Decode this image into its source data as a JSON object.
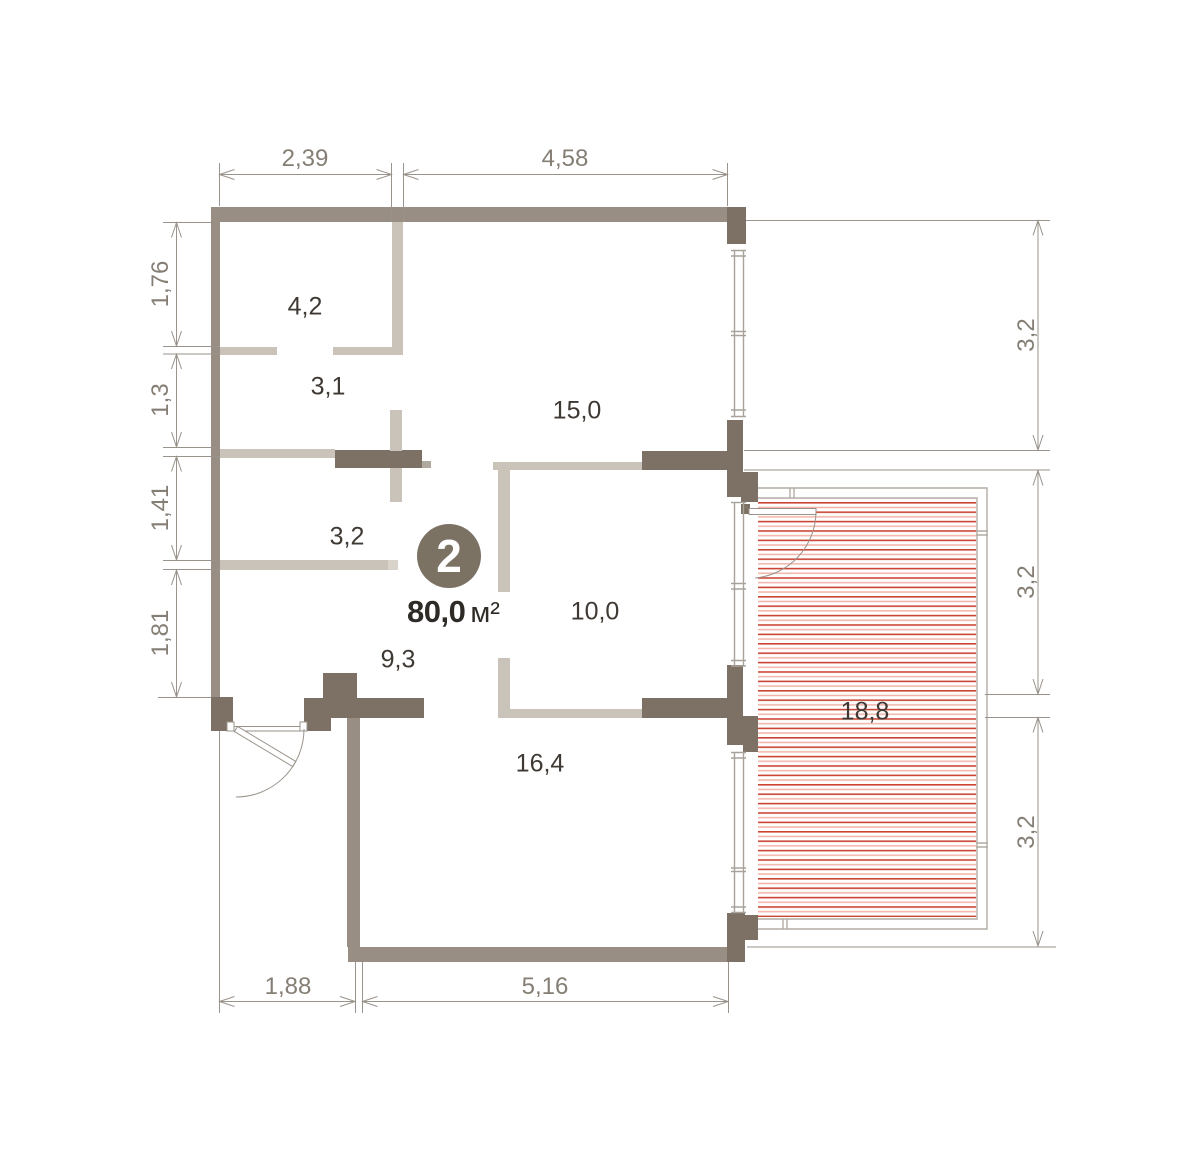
{
  "plan": {
    "badge_number": "2",
    "area_value": "80,0",
    "area_unit": "м²",
    "rooms": [
      {
        "id": "room-4-2",
        "label": "4,2"
      },
      {
        "id": "room-3-1",
        "label": "3,1"
      },
      {
        "id": "room-15-0",
        "label": "15,0"
      },
      {
        "id": "room-3-2",
        "label": "3,2"
      },
      {
        "id": "hall-9-3",
        "label": "9,3"
      },
      {
        "id": "room-10-0",
        "label": "10,0"
      },
      {
        "id": "room-16-4",
        "label": "16,4"
      },
      {
        "id": "terrace-18-8",
        "label": "18,8"
      }
    ],
    "dimensions": {
      "top": [
        "2,39",
        "4,58"
      ],
      "left": [
        "1,76",
        "1,3",
        "1,41",
        "1,81"
      ],
      "right": [
        "3,2",
        "3,2",
        "3,2"
      ],
      "bottom": [
        "1,88",
        "5,16"
      ]
    }
  },
  "colors": {
    "wall_dark": "#7C7164",
    "wall_light": "#988E84",
    "partition": "#C9C3BA",
    "partition_cap": "#D8D3CB",
    "partition_mid": "#AFA89F",
    "window_line": "#A9A29A",
    "frame_line": "#B3ACA3",
    "dim_line": "#9A938B",
    "dim_text": "#857E75",
    "room_text": "#3F3933",
    "area_text": "#2E2A26",
    "badge_bg": "#7B7264",
    "badge_text": "#FFFFFF",
    "hatch_strong": "#CC4434",
    "hatch_light": "#F2B2A8",
    "bg": "#FFFFFF"
  }
}
